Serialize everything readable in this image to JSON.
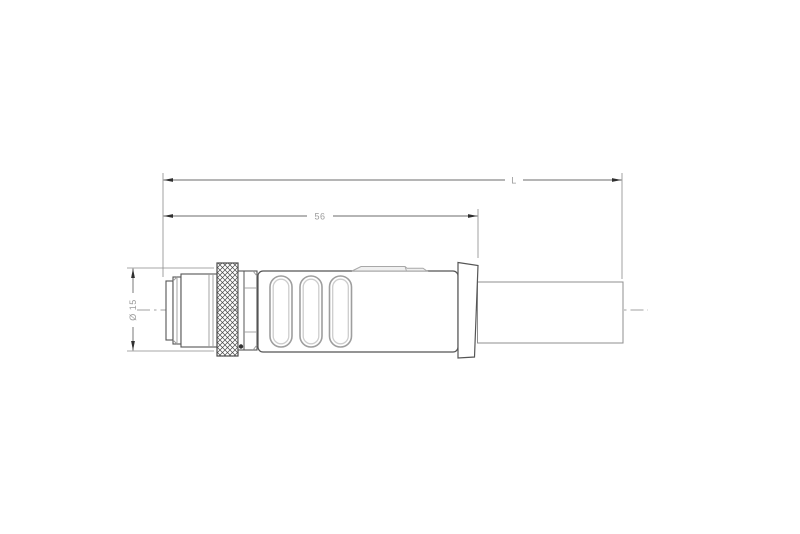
{
  "drawing": {
    "kind": "technical-drawing",
    "subject": "M12 male connector with molded grip body and cable, side view"
  },
  "dimensions": {
    "overall_length": {
      "label": "L"
    },
    "connector_length": {
      "label": "56"
    },
    "diameter": {
      "label": "Ø 15"
    }
  },
  "colors": {
    "background": "#ffffff",
    "outline": "#555555",
    "detail_gray": "#9e9e9e",
    "detail_light": "#c9c9c9",
    "hatch": "#4a4a4a",
    "centerline": "#a0a0a0",
    "dimension_line": "#6b6b6b",
    "extension_line": "#8a8a8a",
    "arrowhead": "#2f2f2f",
    "dimension_text": "#9b9b9b",
    "marking_dot": "#333333",
    "tab_fill": "#f0f0f0"
  }
}
